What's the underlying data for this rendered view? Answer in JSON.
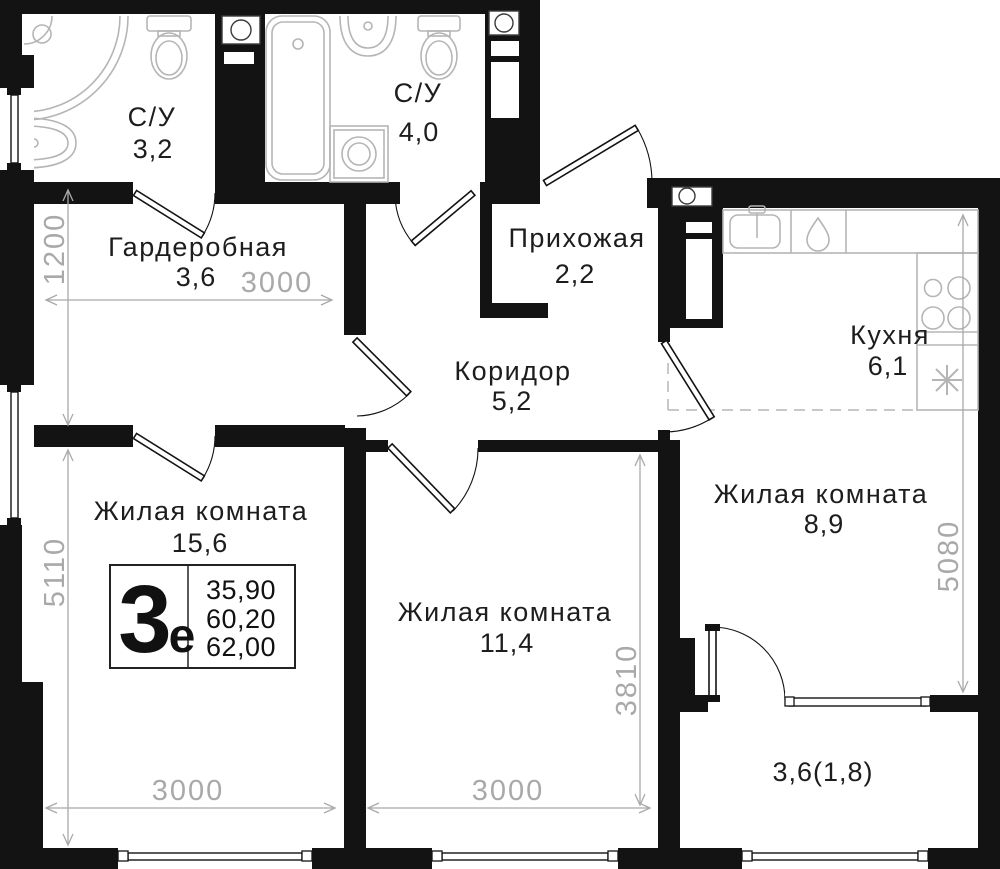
{
  "plan": {
    "rooms": {
      "su1": {
        "label": "С/У",
        "area": "3,2"
      },
      "su2": {
        "label": "С/У",
        "area": "4,0"
      },
      "wardrobe": {
        "label": "Гардеробная",
        "area": "3,6"
      },
      "hall": {
        "label": "Прихожая",
        "area": "2,2"
      },
      "corridor": {
        "label": "Коридор",
        "area": "5,2"
      },
      "kitchen": {
        "label": "Кухня",
        "area": "6,1"
      },
      "living1": {
        "label": "Жилая комната",
        "area": "15,6"
      },
      "living2": {
        "label": "Жилая комната",
        "area": "11,4"
      },
      "living3": {
        "label": "Жилая комната",
        "area": "8,9"
      },
      "balcony": {
        "area": "3,6(1,8)"
      }
    },
    "dims": {
      "wardrobe_depth": "1200",
      "wardrobe_width": "3000",
      "living1_height": "5110",
      "living1_width": "3000",
      "living2_width": "3000",
      "living2_height": "3810",
      "living3_height": "5080"
    },
    "info_box": {
      "type_number": "3",
      "type_letter": "е",
      "areas": [
        "35,90",
        "60,20",
        "62,00"
      ]
    },
    "colors": {
      "wall": "#131313",
      "fixture": "#b5b5b5",
      "dimension": "#a9a9a9",
      "label": "#1d1d1d"
    }
  }
}
